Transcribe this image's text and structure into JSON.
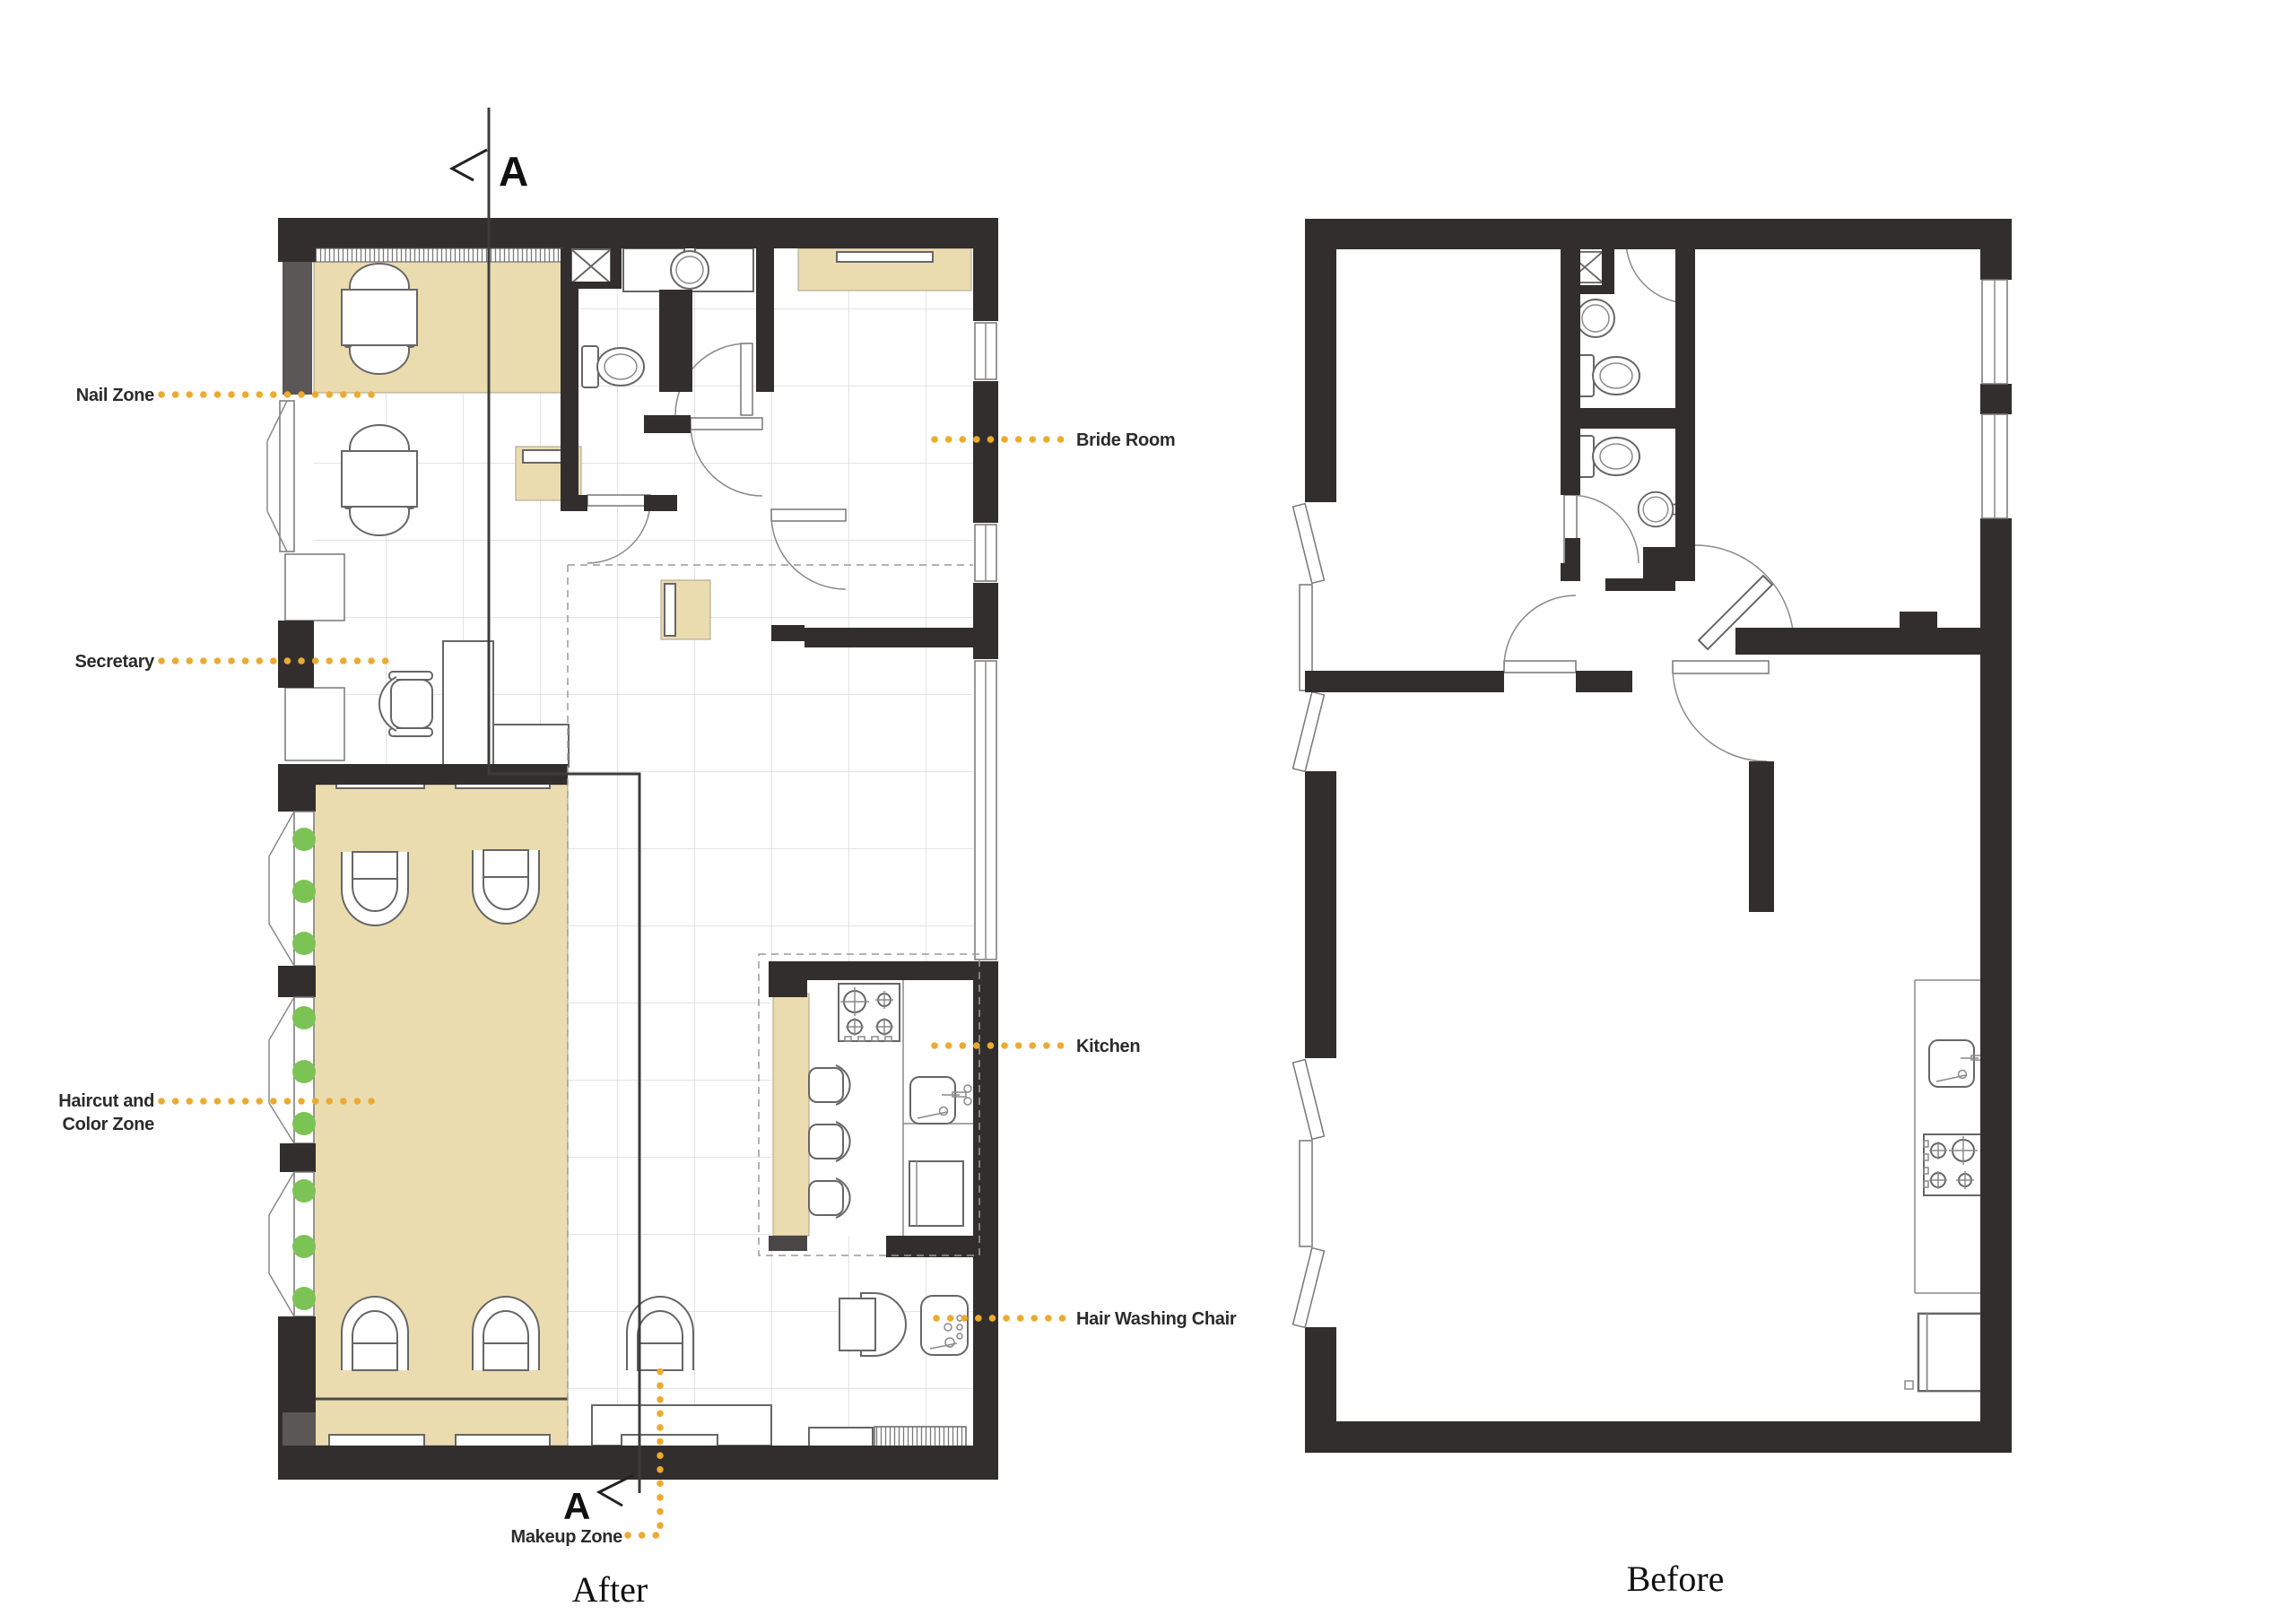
{
  "document": {
    "type": "architectural-floor-plan-comparison",
    "subject": "Beauty salon renovation plan"
  },
  "colors": {
    "wall_dark": "#332e2e",
    "zone_tan": "#ebdcb0",
    "leader_orange": "#ecab2f",
    "plant_green": "#7cc356",
    "grid_gray": "#dadada"
  },
  "after": {
    "caption": "After",
    "section_marker": "A",
    "labels": {
      "nail_zone": "Nail Zone",
      "secretary": "Secretary",
      "haircut_line1": "Haircut and",
      "haircut_line2": "Color Zone",
      "makeup_zone": "Makeup Zone",
      "bride_room": "Bride Room",
      "kitchen": "Kitchen",
      "hair_washing_chair": "Hair Washing Chair"
    }
  },
  "before": {
    "caption": "Before"
  }
}
